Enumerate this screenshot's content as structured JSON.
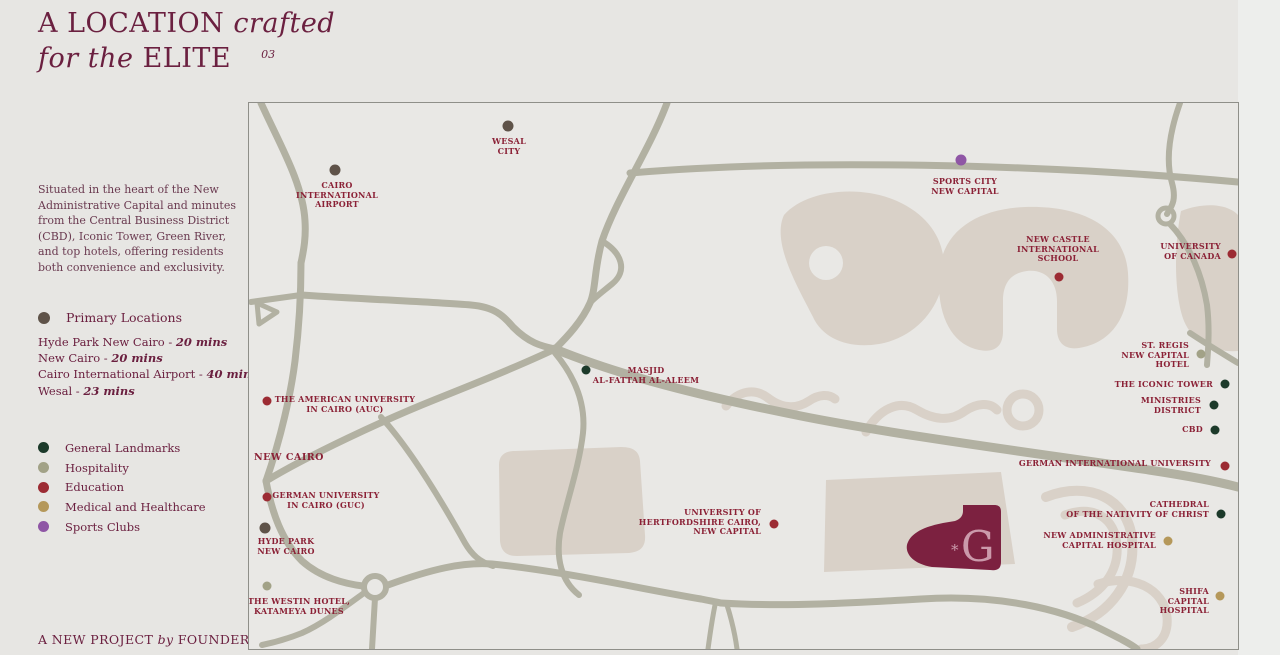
{
  "header": {
    "title_caps1": "A LOCATION",
    "title_italic1": "crafted",
    "title_italic2": "for the",
    "title_caps2": "ELITE",
    "page_number": "03"
  },
  "sidebar": {
    "description": "Situated in the heart of the New Administrative Capital and minutes from the Central Business District (CBD), Iconic Tower, Green River, and top hotels, offering residents both convenience and exclusivity.",
    "primary_legend_label": "Primary Locations",
    "distances": [
      {
        "place": "Hyde Park New Cairo -",
        "time": "20 mins"
      },
      {
        "place": "New Cairo -",
        "time": "20 mins"
      },
      {
        "place": "Cairo International Airport -",
        "time": "40 mins"
      },
      {
        "place": "Wesal -",
        "time": "23 mins"
      }
    ],
    "categories": [
      {
        "label": "General Landmarks",
        "color": "#1c3a2a"
      },
      {
        "label": "Hospitality",
        "color": "#a2a287"
      },
      {
        "label": "Education",
        "color": "#9c2b33"
      },
      {
        "label": "Medical and Healthcare",
        "color": "#b5985a"
      },
      {
        "label": "Sports Clubs",
        "color": "#8f56a5"
      }
    ],
    "footer_pre": "A NEW PROJECT",
    "footer_italic": "by",
    "footer_brand": "FOUNDERS"
  },
  "map": {
    "category_colors": {
      "primary": "#5f5349",
      "general": "#1c3a2a",
      "hospitality": "#a2a287",
      "education": "#9c2b33",
      "medical": "#b5985a",
      "sports": "#8f56a5"
    },
    "site": {
      "letter": "G",
      "ornament": "*",
      "color": "#7c2140",
      "letter_color": "#cb9aab"
    },
    "markers": [
      {
        "id": "wesal-city",
        "category": "primary",
        "dot": [
          259,
          23
        ],
        "label": {
          "x": 260,
          "y": 34,
          "align": "center"
        },
        "lines": [
          "WESAL",
          "CITY"
        ]
      },
      {
        "id": "cairo-international-airport",
        "category": "primary",
        "dot": [
          86,
          67
        ],
        "label": {
          "x": 88,
          "y": 78,
          "align": "center"
        },
        "lines": [
          "CAIRO",
          "INTERNATIONAL",
          "AIRPORT"
        ]
      },
      {
        "id": "sports-city-new-capital",
        "category": "sports",
        "dot": [
          712,
          57
        ],
        "label": {
          "x": 716,
          "y": 74,
          "align": "center"
        },
        "lines": [
          "SPORTS CITY",
          "NEW CAPITAL"
        ]
      },
      {
        "id": "new-castle-international-school",
        "category": "education",
        "dot": [
          810,
          174
        ],
        "label": {
          "x": 809,
          "y": 132,
          "align": "center"
        },
        "lines": [
          "NEW CASTLE",
          "INTERNATIONAL",
          "SCHOOL"
        ]
      },
      {
        "id": "university-of-canada",
        "category": "education",
        "dot": [
          983,
          151
        ],
        "label": {
          "x": 972,
          "y": 139,
          "align": "right"
        },
        "lines": [
          "UNIVERSITY",
          "OF CANADA"
        ]
      },
      {
        "id": "masjid-al-fattah-al-aleem",
        "category": "general",
        "dot": [
          337,
          267
        ],
        "label": {
          "x": 397,
          "y": 263,
          "align": "center"
        },
        "lines": [
          "MASJID",
          "AL-FATTAH AL-ALEEM"
        ]
      },
      {
        "id": "st-regis-new-capital-hotel",
        "category": "hospitality",
        "dot": [
          952,
          251
        ],
        "label": {
          "x": 940,
          "y": 238,
          "align": "right"
        },
        "lines": [
          "ST. REGIS",
          "NEW CAPITAL",
          "HOTEL"
        ]
      },
      {
        "id": "the-iconic-tower",
        "category": "general",
        "dot": [
          976,
          281
        ],
        "label": {
          "x": 964,
          "y": 277,
          "align": "right"
        },
        "lines": [
          "THE ICONIC TOWER"
        ]
      },
      {
        "id": "ministries-district",
        "category": "general",
        "dot": [
          965,
          302
        ],
        "label": {
          "x": 952,
          "y": 293,
          "align": "right"
        },
        "lines": [
          "MINISTRIES",
          "DISTRICT"
        ]
      },
      {
        "id": "cbd",
        "category": "general",
        "dot": [
          966,
          327
        ],
        "label": {
          "x": 954,
          "y": 322,
          "align": "right"
        },
        "lines": [
          "CBD"
        ]
      },
      {
        "id": "german-international-university",
        "category": "education",
        "dot": [
          976,
          363
        ],
        "label": {
          "x": 962,
          "y": 356,
          "align": "right"
        },
        "lines": [
          "GERMAN INTERNATIONAL UNIVERSITY"
        ]
      },
      {
        "id": "cathedral-of-the-nativity-of-christ",
        "category": "general",
        "dot": [
          972,
          411
        ],
        "label": {
          "x": 960,
          "y": 397,
          "align": "right"
        },
        "lines": [
          "CATHEDRAL",
          "OF THE NATIVITY OF CHRIST"
        ]
      },
      {
        "id": "new-administrative-capital-hospital",
        "category": "medical",
        "dot": [
          919,
          438
        ],
        "label": {
          "x": 907,
          "y": 428,
          "align": "right"
        },
        "lines": [
          "NEW ADMINISTRATIVE",
          "CAPITAL HOSPITAL"
        ]
      },
      {
        "id": "shifa-capital-hospital",
        "category": "medical",
        "dot": [
          971,
          493
        ],
        "label": {
          "x": 960,
          "y": 484,
          "align": "right"
        },
        "lines": [
          "SHIFA",
          "CAPITAL",
          "HOSPITAL"
        ]
      },
      {
        "id": "american-university-in-cairo",
        "category": "education",
        "dot": [
          18,
          298
        ],
        "label": {
          "x": 96,
          "y": 292,
          "align": "center"
        },
        "lines": [
          "THE AMERICAN UNIVERSITY",
          "IN CAIRO (AUC)"
        ]
      },
      {
        "id": "german-university-in-cairo",
        "category": "education",
        "dot": [
          18,
          394
        ],
        "label": {
          "x": 77,
          "y": 388,
          "align": "center"
        },
        "lines": [
          "GERMAN UNIVERSITY",
          "IN CAIRO (GUC)"
        ]
      },
      {
        "id": "hyde-park-new-cairo",
        "category": "primary",
        "dot": [
          16,
          425
        ],
        "label": {
          "x": 37,
          "y": 434,
          "align": "center"
        },
        "lines": [
          "HYDE PARK",
          "NEW CAIRO"
        ]
      },
      {
        "id": "the-westin-hotel-katameya-dunes",
        "category": "hospitality",
        "dot": [
          18,
          483
        ],
        "label": {
          "x": 50,
          "y": 494,
          "align": "center"
        },
        "lines": [
          "THE WESTIN HOTEL,",
          "KATAMEYA DUNES"
        ]
      },
      {
        "id": "university-of-hertfordshire-cairo",
        "category": "education",
        "dot": [
          525,
          421
        ],
        "label": {
          "x": 512,
          "y": 405,
          "align": "right"
        },
        "lines": [
          "UNIVERSITY OF",
          "HERTFORDSHIRE CAIRO,",
          "NEW CAPITAL"
        ]
      },
      {
        "id": "new-cairo-region",
        "category": null,
        "dot": null,
        "label": {
          "x": 5,
          "y": 350,
          "align": "left",
          "size": "lg"
        },
        "lines": [
          "NEW CAIRO"
        ]
      }
    ]
  }
}
